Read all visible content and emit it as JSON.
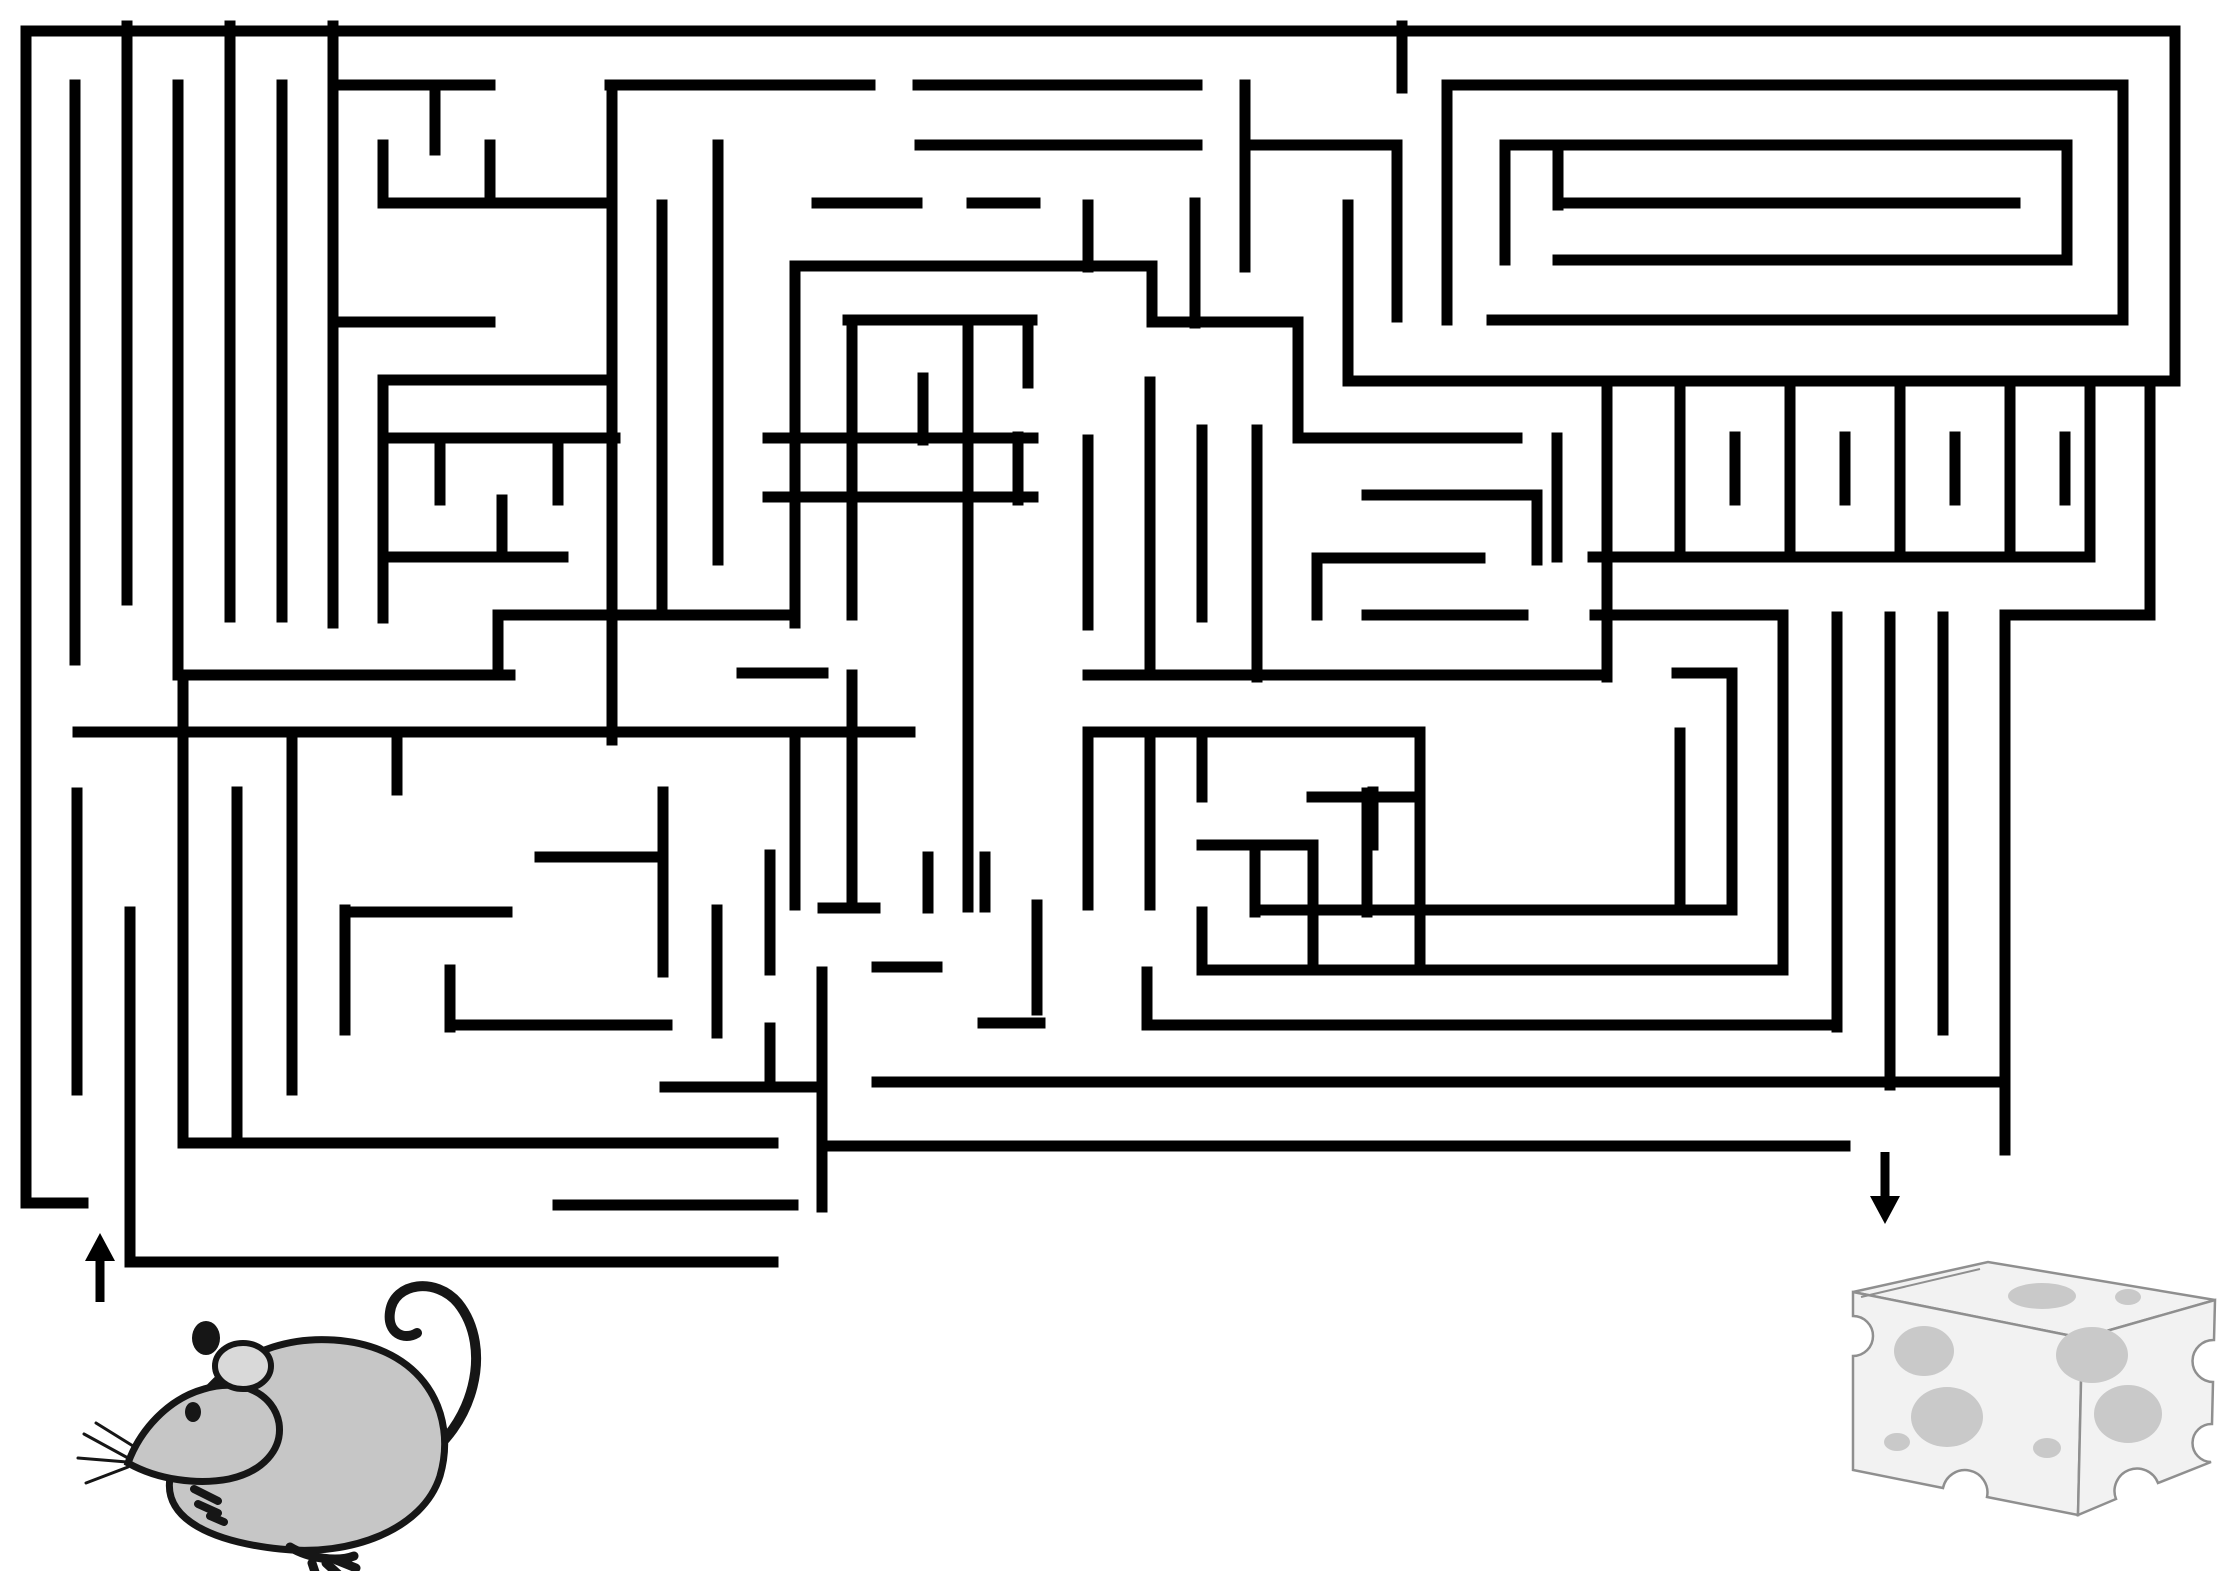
{
  "canvas": {
    "width": 2236,
    "height": 1571,
    "background": "#ffffff"
  },
  "puzzle": {
    "type": "maze-worksheet",
    "start_marker": "mouse",
    "goal_marker": "cheese"
  },
  "maze": {
    "wall_color": "#000000",
    "wall_thickness": 11,
    "entrance": {
      "side": "bottom-left",
      "gap_x": [
        84,
        130
      ],
      "y": 1232
    },
    "exit": {
      "side": "bottom-right",
      "gap_x": [
        1845,
        2005
      ],
      "y": 1146
    },
    "h_walls": [
      [
        26,
        2175,
        31
      ],
      [
        333,
        490,
        85
      ],
      [
        610,
        870,
        85
      ],
      [
        918,
        1197,
        85
      ],
      [
        1447,
        2123,
        85
      ],
      [
        920,
        1197,
        145
      ],
      [
        1250,
        1397,
        145
      ],
      [
        1505,
        2067,
        145
      ],
      [
        383,
        610,
        203
      ],
      [
        817,
        917,
        203
      ],
      [
        972,
        1035,
        203
      ],
      [
        1558,
        2015,
        203
      ],
      [
        1558,
        2067,
        260
      ],
      [
        798,
        1152,
        266
      ],
      [
        333,
        490,
        322
      ],
      [
        848,
        1032,
        320
      ],
      [
        1152,
        1298,
        322
      ],
      [
        1492,
        2123,
        320
      ],
      [
        383,
        607,
        380
      ],
      [
        1348,
        2175,
        381
      ],
      [
        383,
        615,
        438
      ],
      [
        768,
        1033,
        438
      ],
      [
        1303,
        1517,
        438
      ],
      [
        768,
        1033,
        497
      ],
      [
        1367,
        1537,
        495
      ],
      [
        385,
        563,
        557
      ],
      [
        1593,
        2090,
        557
      ],
      [
        1317,
        1480,
        558
      ],
      [
        498,
        795,
        615
      ],
      [
        1367,
        1523,
        615
      ],
      [
        1595,
        1783,
        615
      ],
      [
        2005,
        2150,
        615
      ],
      [
        183,
        510,
        675
      ],
      [
        742,
        823,
        673
      ],
      [
        1088,
        1607,
        675
      ],
      [
        1677,
        1732,
        673
      ],
      [
        78,
        910,
        732
      ],
      [
        1088,
        1420,
        732
      ],
      [
        1312,
        1420,
        797
      ],
      [
        1202,
        1313,
        845
      ],
      [
        540,
        660,
        857
      ],
      [
        345,
        507,
        912
      ],
      [
        823,
        875,
        908
      ],
      [
        1255,
        1732,
        910
      ],
      [
        877,
        937,
        967
      ],
      [
        1202,
        1783,
        970
      ],
      [
        450,
        667,
        1025
      ],
      [
        983,
        1040,
        1023
      ],
      [
        1147,
        1837,
        1025
      ],
      [
        877,
        2005,
        1082
      ],
      [
        665,
        822,
        1087
      ],
      [
        183,
        773,
        1143
      ],
      [
        830,
        1845,
        1146
      ],
      [
        26,
        83,
        1203
      ],
      [
        558,
        793,
        1205
      ],
      [
        130,
        773,
        1262
      ]
    ],
    "v_walls": [
      [
        26,
        31,
        1203
      ],
      [
        2175,
        31,
        381
      ],
      [
        75,
        85,
        660
      ],
      [
        127,
        26,
        600
      ],
      [
        178,
        85,
        675
      ],
      [
        230,
        26,
        617
      ],
      [
        282,
        85,
        617
      ],
      [
        333,
        26,
        623
      ],
      [
        383,
        145,
        203
      ],
      [
        435,
        85,
        150
      ],
      [
        490,
        145,
        203
      ],
      [
        383,
        380,
        618
      ],
      [
        440,
        438,
        500
      ],
      [
        502,
        500,
        557
      ],
      [
        558,
        438,
        500
      ],
      [
        612,
        85,
        740
      ],
      [
        662,
        205,
        615
      ],
      [
        498,
        615,
        675
      ],
      [
        718,
        145,
        560
      ],
      [
        795,
        266,
        623
      ],
      [
        795,
        737,
        905
      ],
      [
        852,
        320,
        615
      ],
      [
        852,
        675,
        908
      ],
      [
        923,
        378,
        440
      ],
      [
        968,
        320,
        907
      ],
      [
        1028,
        320,
        383
      ],
      [
        1018,
        437,
        500
      ],
      [
        1088,
        205,
        267
      ],
      [
        1088,
        440,
        625
      ],
      [
        1088,
        733,
        905
      ],
      [
        1150,
        382,
        672
      ],
      [
        1150,
        733,
        905
      ],
      [
        1152,
        266,
        322
      ],
      [
        1195,
        203,
        323
      ],
      [
        1202,
        430,
        617
      ],
      [
        1202,
        740,
        797
      ],
      [
        1202,
        912,
        970
      ],
      [
        1245,
        85,
        267
      ],
      [
        1257,
        430,
        677
      ],
      [
        1298,
        322,
        438
      ],
      [
        1313,
        845,
        963
      ],
      [
        1317,
        558,
        615
      ],
      [
        1348,
        205,
        381
      ],
      [
        1367,
        793,
        912
      ],
      [
        1373,
        792,
        845
      ],
      [
        1397,
        147,
        317
      ],
      [
        1402,
        26,
        88
      ],
      [
        1420,
        732,
        970
      ],
      [
        1447,
        85,
        320
      ],
      [
        1505,
        145,
        260
      ],
      [
        1537,
        495,
        560
      ],
      [
        1557,
        438,
        557
      ],
      [
        1558,
        145,
        205
      ],
      [
        1607,
        381,
        677
      ],
      [
        1680,
        381,
        557
      ],
      [
        1790,
        381,
        557
      ],
      [
        1900,
        381,
        557
      ],
      [
        2010,
        381,
        557
      ],
      [
        1735,
        437,
        500
      ],
      [
        1845,
        437,
        500
      ],
      [
        1955,
        437,
        500
      ],
      [
        2065,
        437,
        500
      ],
      [
        2090,
        381,
        557
      ],
      [
        1680,
        733,
        910
      ],
      [
        1732,
        673,
        910
      ],
      [
        1783,
        617,
        970
      ],
      [
        1837,
        617,
        1027
      ],
      [
        1890,
        617,
        1085
      ],
      [
        1943,
        617,
        1030
      ],
      [
        2067,
        145,
        260
      ],
      [
        2123,
        85,
        320
      ],
      [
        2150,
        381,
        615
      ],
      [
        2005,
        615,
        1150
      ],
      [
        77,
        793,
        1090
      ],
      [
        130,
        912,
        1262
      ],
      [
        183,
        675,
        1143
      ],
      [
        237,
        792,
        1140
      ],
      [
        292,
        732,
        1090
      ],
      [
        397,
        732,
        790
      ],
      [
        345,
        910,
        1030
      ],
      [
        450,
        970,
        1027
      ],
      [
        663,
        792,
        972
      ],
      [
        717,
        910,
        1033
      ],
      [
        770,
        855,
        970
      ],
      [
        770,
        1028,
        1087
      ],
      [
        822,
        972,
        1207
      ],
      [
        928,
        857,
        908
      ],
      [
        985,
        857,
        907
      ],
      [
        1037,
        905,
        1010
      ],
      [
        1147,
        972,
        1023
      ],
      [
        1255,
        845,
        912
      ]
    ]
  },
  "arrows": [
    {
      "name": "maze-entrance-arrow",
      "direction": "up",
      "x": 100,
      "tip_y": 1233,
      "tail_y": 1302
    },
    {
      "name": "maze-exit-arrow",
      "direction": "down",
      "x": 1885,
      "tip_y": 1224,
      "tail_y": 1152
    }
  ],
  "mouse": {
    "body_color": "#c6c6c6",
    "ear_inner_color": "#d9d9d9",
    "outline_color": "#161616"
  },
  "cheese": {
    "fill_color": "#f2f2f2",
    "outline_color": "#8f8f8f",
    "hole_color": "#c9c9c9"
  }
}
